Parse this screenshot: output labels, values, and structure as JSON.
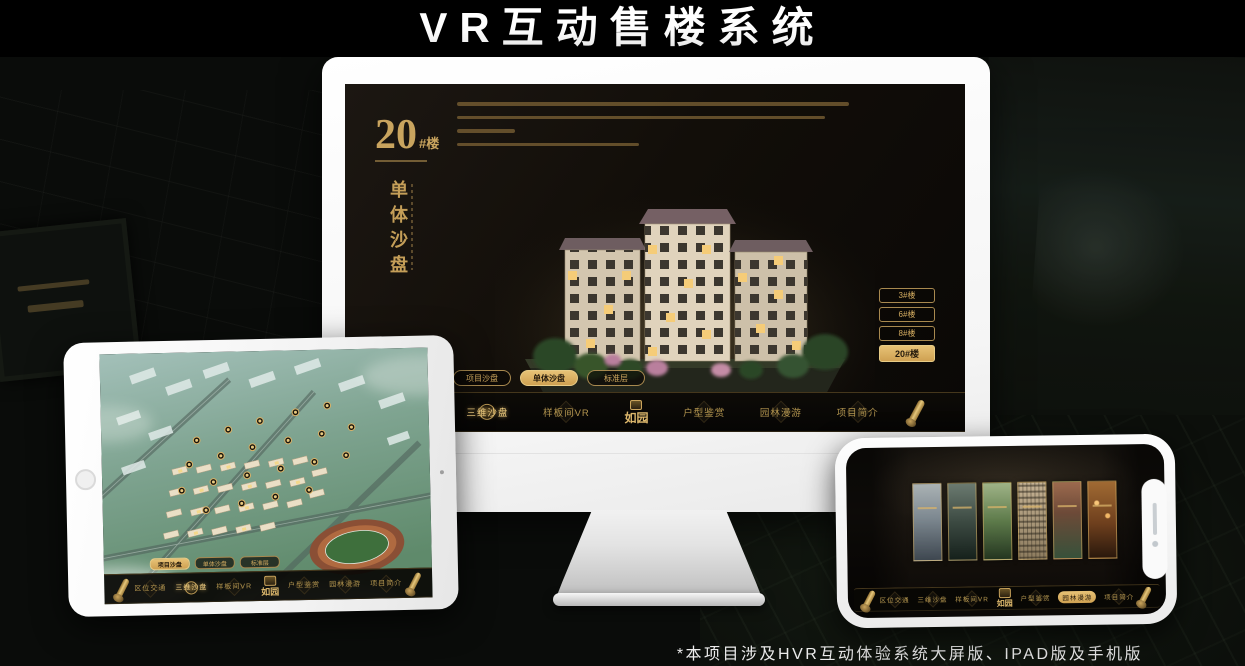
{
  "page": {
    "title": "VR互动售楼系统",
    "footnote": "*本项目涉及HVR互动体验系统大屏版、IPAD版及手机版"
  },
  "colors": {
    "accent_gold": "#d4ae66",
    "active_button_gold": "#e7c276",
    "screen_black": "#12100b",
    "device_frame_white": "#f4f4f4"
  },
  "app_nav": {
    "logo": "如园",
    "items": [
      {
        "label": "区位交通"
      },
      {
        "label": "三维沙盘"
      },
      {
        "label": "样板间VR"
      },
      {
        "label": "户型鉴赏"
      },
      {
        "label": "园林漫游"
      },
      {
        "label": "项目简介"
      }
    ]
  },
  "monitor": {
    "headline": {
      "number": "20",
      "suffix": "#楼",
      "subtitle": "单体沙盘"
    },
    "floor_buttons": [
      {
        "label": "3#楼",
        "active": false
      },
      {
        "label": "6#楼",
        "active": false
      },
      {
        "label": "8#楼",
        "active": false
      },
      {
        "label": "20#楼",
        "active": true
      }
    ],
    "subtabs": [
      {
        "label": "项目沙盘",
        "active": false
      },
      {
        "label": "单体沙盘",
        "active": true
      },
      {
        "label": "标准层",
        "active": false
      }
    ],
    "active_nav": "三维沙盘"
  },
  "ipad": {
    "subtabs": [
      {
        "label": "项目沙盘",
        "active": true
      },
      {
        "label": "单体沙盘",
        "active": false
      },
      {
        "label": "标准层",
        "active": false
      }
    ],
    "active_nav": "三维沙盘"
  },
  "phone": {
    "active_nav": "园林漫游",
    "gallery_panel_count": 6
  }
}
